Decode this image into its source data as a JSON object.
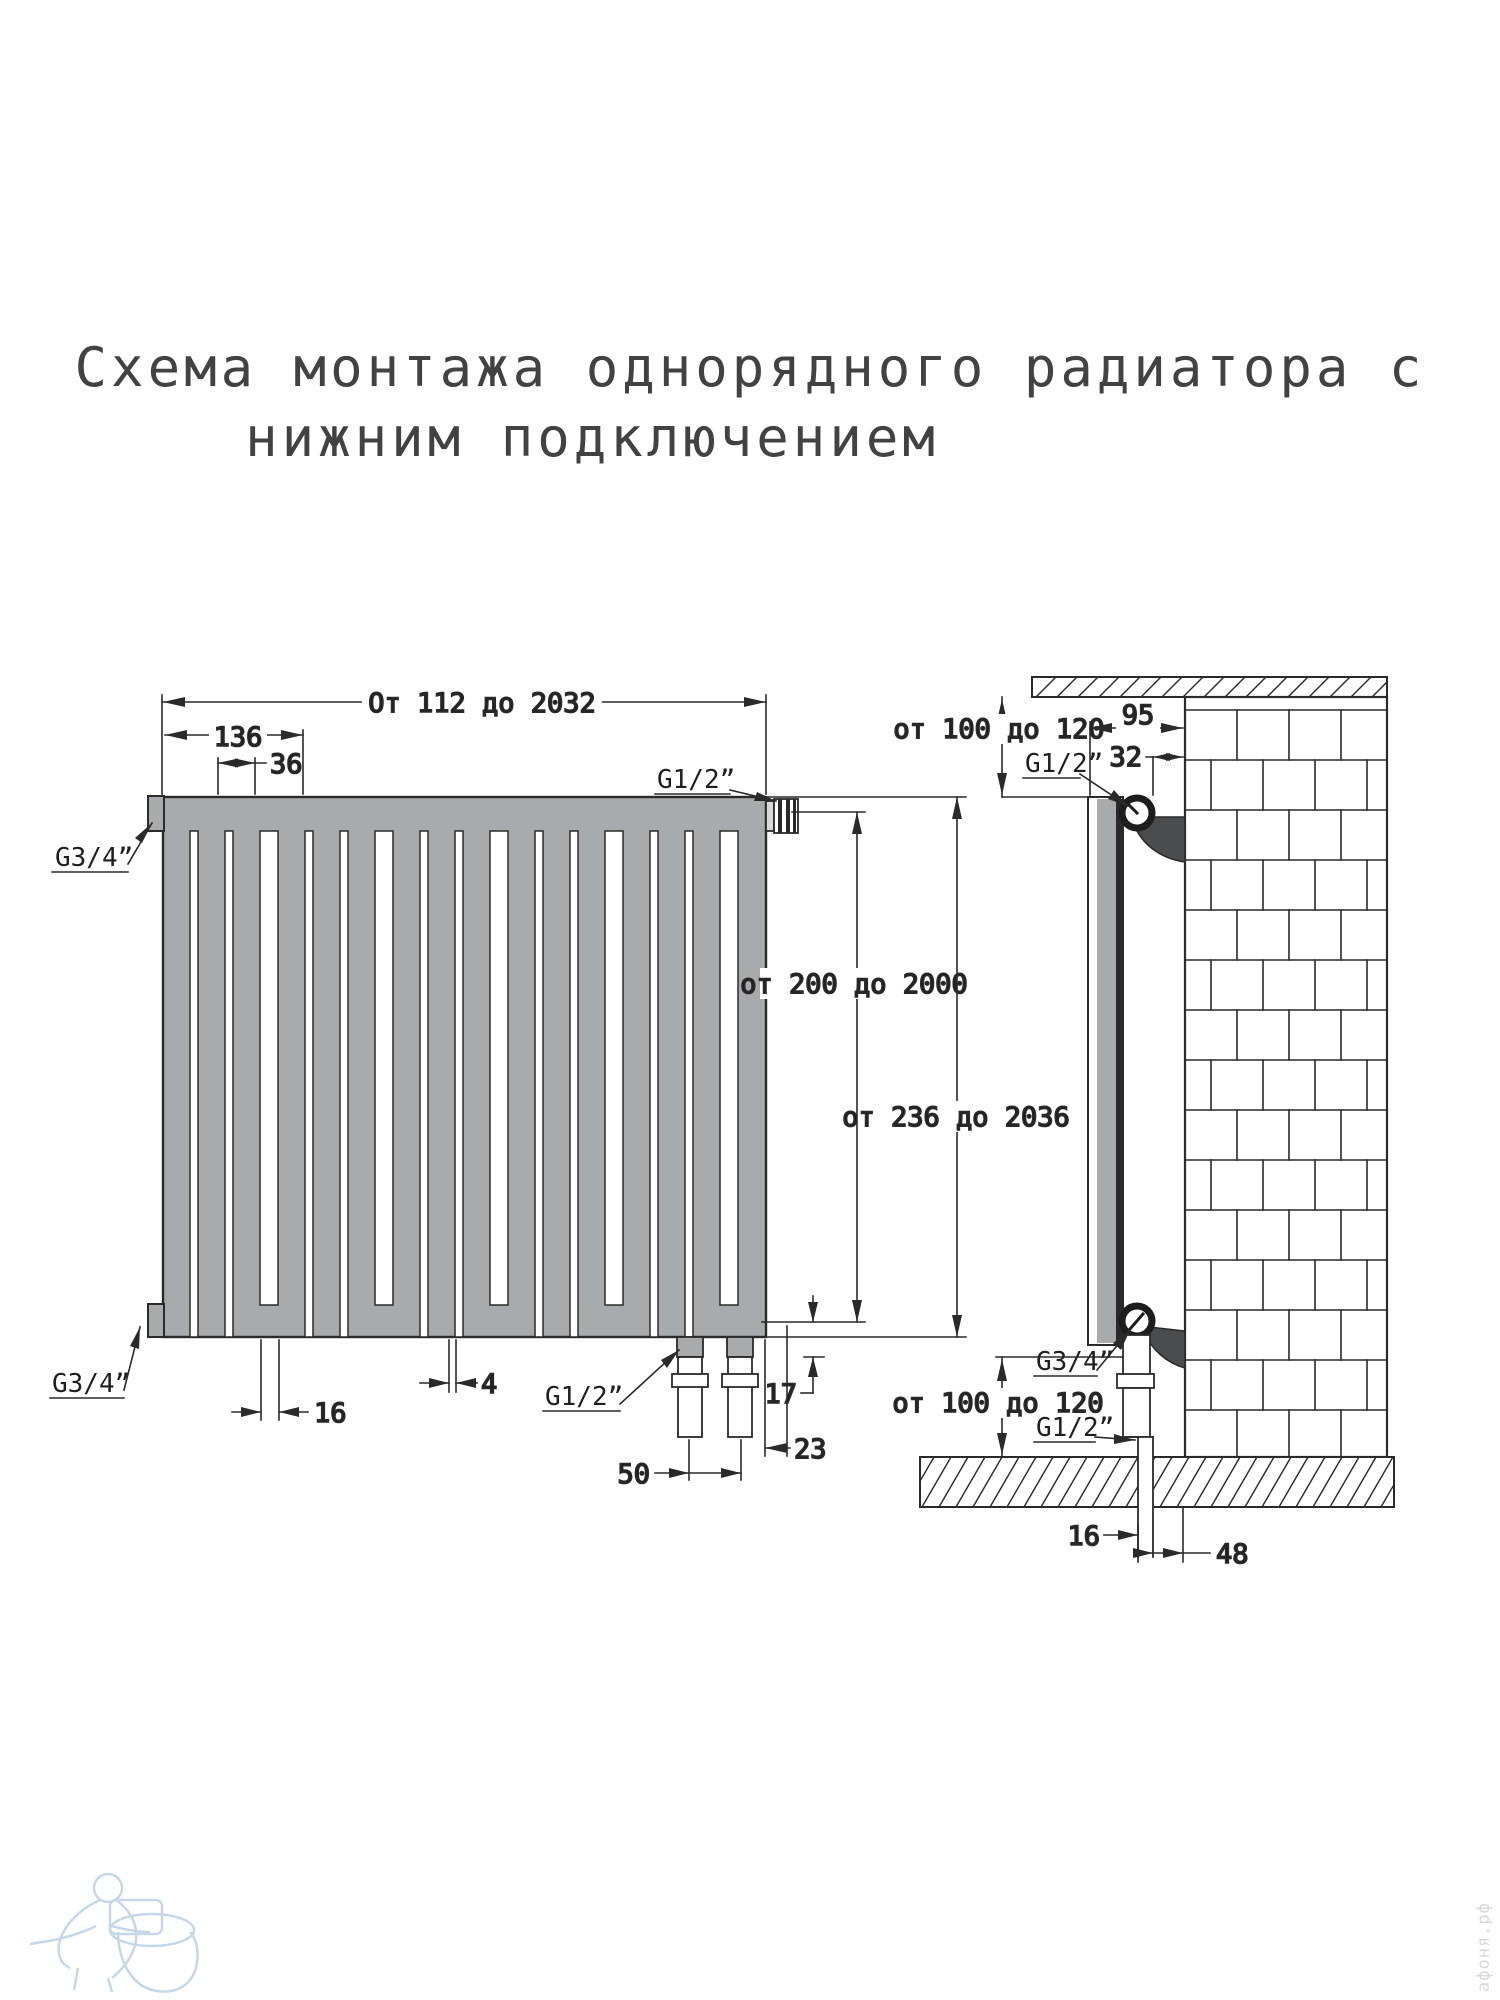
{
  "title": {
    "line1": "Схема монтажа однорядного радиатора с",
    "line2": "нижним подключением"
  },
  "front_view": {
    "dim_width_range": "От 112 до 2032",
    "dim_bracket_offset": "136",
    "dim_section_pitch": "36",
    "label_g34_top": "G3/4”",
    "label_g12_top": "G1/2”",
    "label_g34_bottom": "G3/4”",
    "label_g12_bottom": "G1/2”",
    "dim_axis_height_range": "от 200 до 2000",
    "dim_total_height_range": "от 236 до 2036",
    "dim_16": "16",
    "dim_4": "4",
    "dim_17": "17",
    "dim_23": "23",
    "dim_50": "50"
  },
  "side_view": {
    "dim_top_clearance": "от 100 до 120",
    "dim_95": "95",
    "dim_32": "32",
    "label_g12_top": "G1/2”",
    "label_g34_bottom": "G3/4”",
    "label_g12_bottom": "G1/2”",
    "dim_bottom_clearance": "от 100 до 120",
    "dim_16": "16",
    "dim_48": "48"
  },
  "watermark": {
    "site": "афоня.рф"
  },
  "colors": {
    "line": "#2a2a2a",
    "radiator_gray": "#a8aaac",
    "bracket_dark": "#4a4c4e",
    "watermark_blue": "#bdd2e4"
  }
}
